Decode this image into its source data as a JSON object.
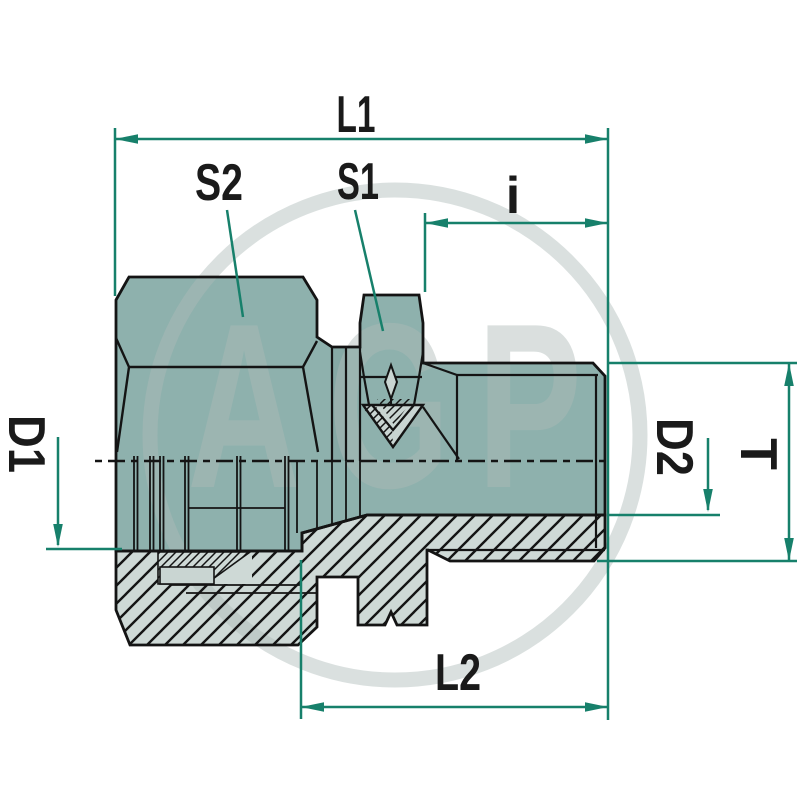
{
  "title": "Hydraulic male stud fitting technical drawing",
  "watermark": {
    "text": "AGP"
  },
  "dimensions": {
    "l1": "L1",
    "s2": "S2",
    "s1": "S1",
    "i": "i",
    "d1": "D1",
    "d2": "D2",
    "t": "T",
    "l2": "L2"
  },
  "colors": {
    "body": "#8EB1AD",
    "section": "#CED9D6",
    "pale": "#C9D5D2",
    "line": "#141414",
    "dim": "#17806B",
    "wm": "#AEBAB8"
  }
}
